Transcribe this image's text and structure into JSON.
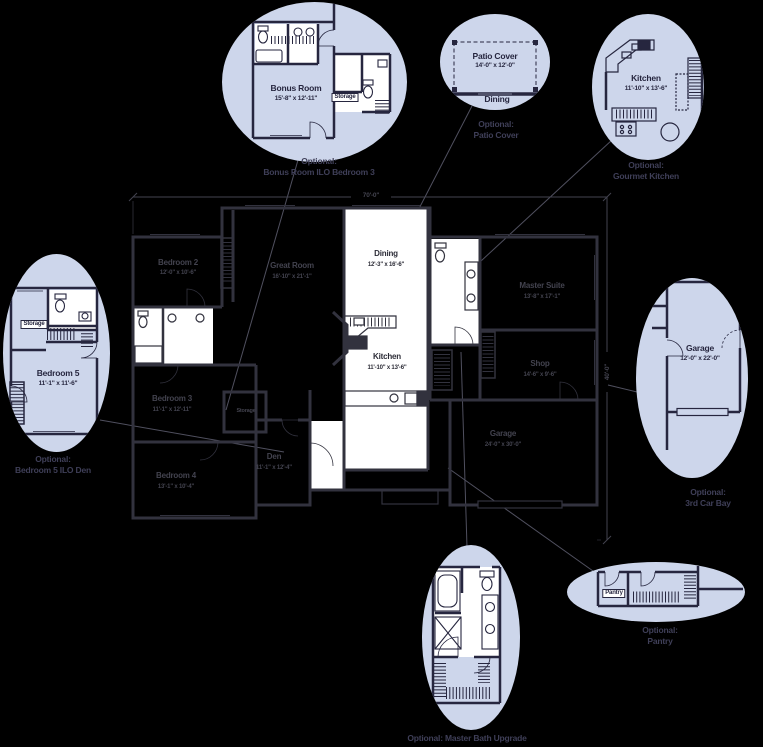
{
  "palette": {
    "background": "#000000",
    "oval_fill": "#cdd6eb",
    "plan_ink": "#26263f",
    "main_wall": "#32323e",
    "text_dark": "#43434f",
    "caption": "#3f3f58",
    "white": "#ffffff"
  },
  "dimensions": {
    "width": "70'-0\"",
    "depth": "40'-0\""
  },
  "main_plan": {
    "bedroom2": {
      "name": "Bedroom 2",
      "size": "12'-0\" x 10'-6\""
    },
    "great_room": {
      "name": "Great Room",
      "size": "16'-10\" x 21'-1\""
    },
    "dining": {
      "name": "Dining",
      "size": "12'-3\" x 16'-6\""
    },
    "kitchen": {
      "name": "Kitchen",
      "size": "11'-10\" x 13'-6\""
    },
    "master_suite": {
      "name": "Master Suite",
      "size": "13'-8\" x 17'-1\""
    },
    "shop": {
      "name": "Shop",
      "size": "14'-6\" x 9'-6\""
    },
    "garage": {
      "name": "Garage",
      "size": "24'-0\" x 30'-0\""
    },
    "bedroom3": {
      "name": "Bedroom 3",
      "size": "11'-1\" x 12'-11\""
    },
    "den": {
      "name": "Den",
      "size": "11'-1\" x 12'-4\""
    },
    "bedroom4": {
      "name": "Bedroom 4",
      "size": "13'-1\" x 10'-4\""
    },
    "storage": {
      "name": "Storage"
    }
  },
  "callouts": {
    "bonus": {
      "room": "Bonus Room",
      "size": "15'-8\" x 12'-11\"",
      "storage": "Storage",
      "cap1": "Optional:",
      "cap2": "Bonus Room ILO Bedroom 3"
    },
    "patio": {
      "room": "Patio Cover",
      "size": "14'-0\" x 12'-0\"",
      "adjacent": "Dining",
      "cap1": "Optional:",
      "cap2": "Patio Cover"
    },
    "gourmet": {
      "room": "Kitchen",
      "size": "11'-10\" x 13'-6\"",
      "cap1": "Optional:",
      "cap2": "Gourmet Kitchen"
    },
    "bedroom5": {
      "room": "Bedroom 5",
      "size": "11'-1\" x 11'-6\"",
      "storage": "Storage",
      "cap1": "Optional:",
      "cap2": "Bedroom 5 ILO Den"
    },
    "car_bay": {
      "room": "Garage",
      "size": "12'-0\" x 22'-0\"",
      "cap1": "Optional:",
      "cap2": "3rd Car Bay"
    },
    "master_bath": {
      "cap1": "Optional: Master Bath Upgrade"
    },
    "pantry": {
      "room": "Pantry",
      "cap1": "Optional:",
      "cap2": "Pantry"
    }
  }
}
